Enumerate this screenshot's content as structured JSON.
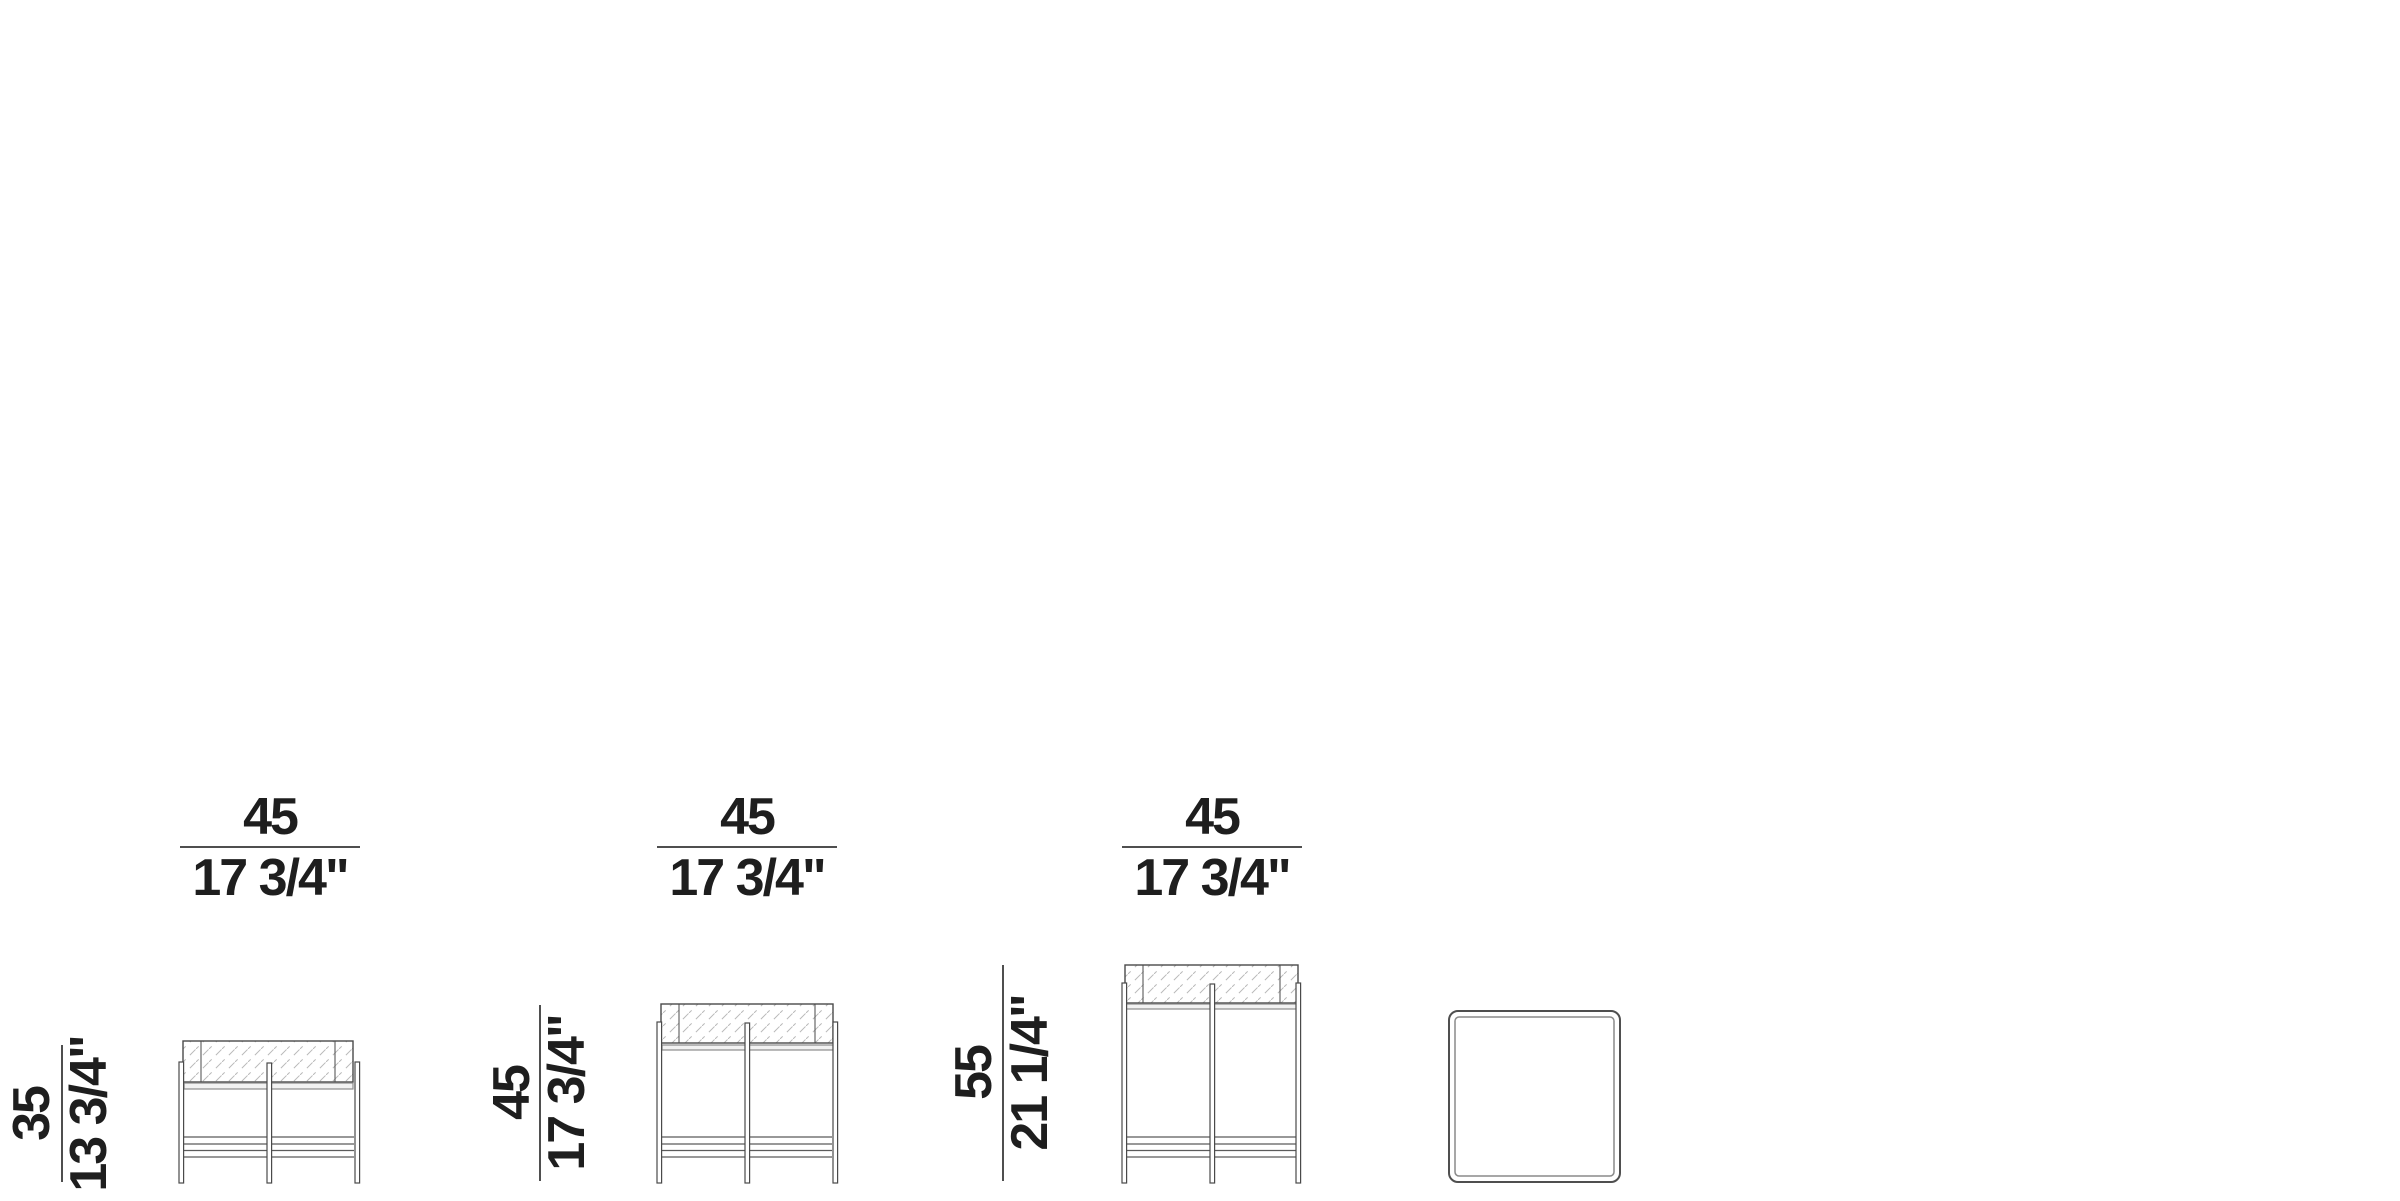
{
  "diagram": {
    "description": "Side table dimension drawings: three front elevations and one top view",
    "unit_style": "centimeters over inches fraction",
    "colors": {
      "background": "#ffffff",
      "outline": "#4a4a4a",
      "light_line": "#8c8c8c",
      "hatch": "#b9b9b9",
      "text": "#1e1e1e"
    }
  },
  "figures": [
    {
      "name": "side-table-h35-front-elevation",
      "width_cm": "45",
      "width_in": "17 3/4\"",
      "height_cm": "35",
      "height_in": "13 3/4\""
    },
    {
      "name": "side-table-h45-front-elevation",
      "width_cm": "45",
      "width_in": "17 3/4\"",
      "height_cm": "45",
      "height_in": "17 3/4\""
    },
    {
      "name": "side-table-h55-front-elevation",
      "width_cm": "45",
      "width_in": "17 3/4\"",
      "height_cm": "55",
      "height_in": "21 1/4\""
    },
    {
      "name": "table-top-view"
    }
  ]
}
